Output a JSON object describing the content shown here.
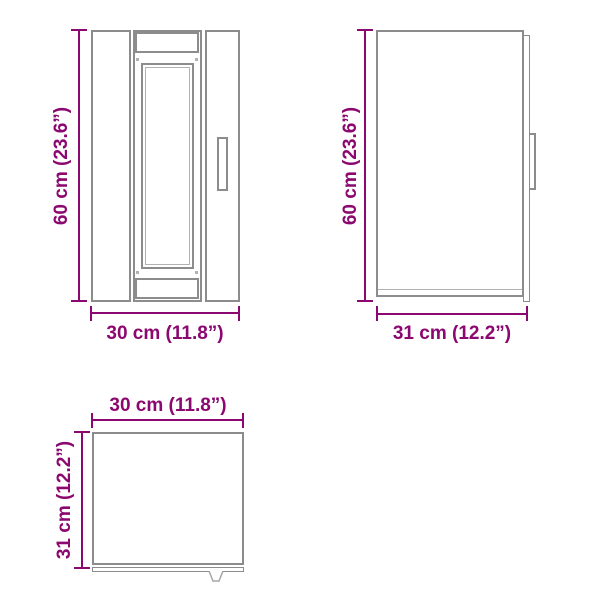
{
  "colors": {
    "dimension": "#8b0870",
    "outline": "#8c8c8c",
    "outline-light": "#b2b2b2",
    "fill": "#ffffff"
  },
  "views": {
    "front": {
      "name": "front view",
      "height_label": "60 cm (23.6”)",
      "width_label": "30 cm (11.8”)"
    },
    "side": {
      "name": "side view",
      "height_label": "60 cm (23.6”)",
      "width_label": "31 cm (12.2”)"
    },
    "top": {
      "name": "top view",
      "width_label": "30 cm (11.8”)",
      "depth_label": "31 cm (12.2”)"
    }
  }
}
